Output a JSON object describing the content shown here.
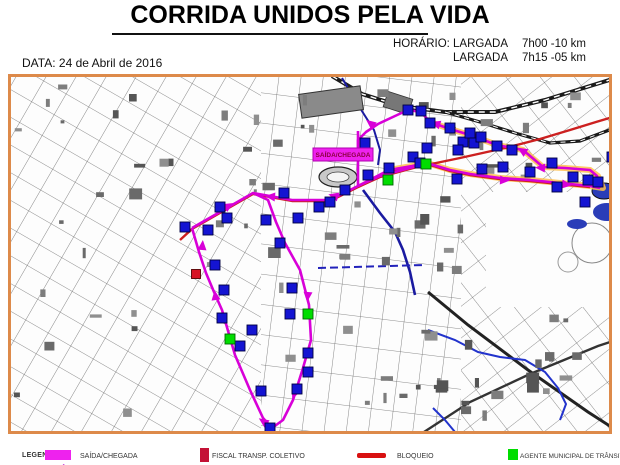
{
  "header": {
    "title": "CORRIDA UNIDOS PELA VIDA",
    "date_label": "DATA: 24 de Abril  de 2016",
    "schedule": {
      "prefix": "HORÁRIO: ",
      "row1": {
        "label": "LARGADA",
        "value": "7h00 -10 km"
      },
      "row2": {
        "label": "LARGADA",
        "value": "7h15 -05 km"
      }
    }
  },
  "colors": {
    "map_border": "#dd8a4a",
    "course": "#d800d8",
    "course_glow": "#ffc04d",
    "start_finish_bg": "#ee22ee",
    "start_finish_text": "#8b0040",
    "bloqueio": "#cc2020",
    "checkpoint_blue": "#1414d2",
    "agent_green": "#00dd00",
    "inspector_red": "#d81324",
    "railway": "#1a1a1a",
    "water": "#2a3db8"
  },
  "map": {
    "start_finish_label": "SAÍDA/CHEGADA",
    "start_finish_box": {
      "x": 313,
      "y": 148,
      "w": 60,
      "h": 13
    },
    "route": {
      "glow": [
        [
          [
            389,
            170
          ],
          [
            412,
            166
          ],
          [
            427,
            163
          ],
          [
            450,
            170
          ],
          [
            470,
            174
          ],
          [
            500,
            178
          ],
          [
            530,
            180
          ],
          [
            560,
            183
          ],
          [
            590,
            186
          ],
          [
            603,
            188
          ],
          [
            598,
            176
          ],
          [
            590,
            170
          ],
          [
            565,
            168
          ],
          [
            543,
            167
          ],
          [
            523,
            150
          ],
          [
            497,
            145
          ],
          [
            470,
            135
          ],
          [
            450,
            129
          ],
          [
            430,
            122
          ]
        ]
      ],
      "bloqueio": [
        [
          [
            616,
            116
          ],
          [
            596,
            122
          ],
          [
            570,
            130
          ],
          [
            540,
            139
          ],
          [
            505,
            148
          ],
          [
            460,
            158
          ],
          [
            417,
            167
          ]
        ],
        [
          [
            417,
            167
          ],
          [
            380,
            177
          ],
          [
            358,
            187
          ],
          [
            330,
            201
          ],
          [
            292,
            201
          ],
          [
            253,
            194
          ],
          [
            192,
            229
          ],
          [
            180,
            240
          ]
        ],
        [
          [
            358,
            187
          ],
          [
            389,
            171
          ],
          [
            412,
            167
          ],
          [
            427,
            164
          ],
          [
            450,
            171
          ],
          [
            470,
            175
          ],
          [
            500,
            179
          ],
          [
            530,
            181
          ],
          [
            560,
            184
          ],
          [
            590,
            187
          ]
        ]
      ],
      "course": [
        [
          [
            358,
            131
          ],
          [
            358,
            186
          ]
        ],
        [
          [
            417,
            166
          ],
          [
            380,
            176
          ],
          [
            358,
            186
          ],
          [
            330,
            200
          ],
          [
            292,
            200
          ],
          [
            253,
            193
          ],
          [
            192,
            228
          ]
        ],
        [
          [
            192,
            228
          ],
          [
            199,
            252
          ],
          [
            206,
            273
          ],
          [
            214,
            292
          ],
          [
            222,
            310
          ],
          [
            235,
            355
          ],
          [
            250,
            390
          ],
          [
            263,
            418
          ],
          [
            272,
            428
          ],
          [
            283,
            420
          ],
          [
            293,
            400
          ],
          [
            303,
            368
          ],
          [
            311,
            340
          ],
          [
            309,
            305
          ],
          [
            300,
            270
          ],
          [
            285,
            243
          ],
          [
            276,
            222
          ],
          [
            268,
            200
          ],
          [
            253,
            193
          ]
        ],
        [
          [
            358,
            186
          ],
          [
            389,
            170
          ],
          [
            412,
            166
          ],
          [
            427,
            163
          ],
          [
            450,
            170
          ],
          [
            470,
            174
          ],
          [
            500,
            178
          ],
          [
            530,
            180
          ],
          [
            560,
            183
          ],
          [
            590,
            186
          ],
          [
            600,
            188
          ]
        ],
        [
          [
            600,
            188
          ],
          [
            597,
            176
          ],
          [
            590,
            170
          ],
          [
            565,
            168
          ],
          [
            543,
            167
          ],
          [
            523,
            150
          ],
          [
            497,
            145
          ],
          [
            470,
            135
          ],
          [
            450,
            129
          ],
          [
            430,
            122
          ],
          [
            421,
            112
          ],
          [
            408,
            110
          ]
        ],
        [
          [
            408,
            110
          ],
          [
            395,
            116
          ],
          [
            378,
            124
          ],
          [
            366,
            132
          ],
          [
            358,
            140
          ],
          [
            358,
            150
          ]
        ]
      ]
    },
    "arrows": [
      {
        "x": 338,
        "y": 197,
        "a": 195
      },
      {
        "x": 275,
        "y": 197,
        "a": 185
      },
      {
        "x": 225,
        "y": 208,
        "a": 330
      },
      {
        "x": 308,
        "y": 292,
        "a": 95
      },
      {
        "x": 296,
        "y": 390,
        "a": 112
      },
      {
        "x": 267,
        "y": 424,
        "a": 215
      },
      {
        "x": 216,
        "y": 300,
        "a": 262
      },
      {
        "x": 202,
        "y": 250,
        "a": 275
      },
      {
        "x": 480,
        "y": 137,
        "a": 197
      },
      {
        "x": 526,
        "y": 153,
        "a": 212
      },
      {
        "x": 545,
        "y": 168,
        "a": 183
      },
      {
        "x": 440,
        "y": 125,
        "a": 197
      },
      {
        "x": 374,
        "y": 126,
        "a": 218
      },
      {
        "x": 500,
        "y": 180,
        "a": 3
      },
      {
        "x": 562,
        "y": 184,
        "a": 8
      }
    ],
    "markers": {
      "blue": [
        [
          408,
          110
        ],
        [
          421,
          111
        ],
        [
          430,
          123
        ],
        [
          450,
          128
        ],
        [
          463,
          142
        ],
        [
          470,
          133
        ],
        [
          474,
          143
        ],
        [
          481,
          137
        ],
        [
          497,
          146
        ],
        [
          512,
          150
        ],
        [
          427,
          148
        ],
        [
          458,
          150
        ],
        [
          457,
          179
        ],
        [
          482,
          169
        ],
        [
          503,
          167
        ],
        [
          530,
          172
        ],
        [
          552,
          163
        ],
        [
          557,
          187
        ],
        [
          573,
          177
        ],
        [
          588,
          180
        ],
        [
          598,
          182
        ],
        [
          585,
          202
        ],
        [
          612,
          157
        ],
        [
          365,
          143
        ],
        [
          413,
          157
        ],
        [
          389,
          168
        ],
        [
          368,
          175
        ],
        [
          420,
          163
        ],
        [
          345,
          190
        ],
        [
          330,
          202
        ],
        [
          319,
          207
        ],
        [
          298,
          218
        ],
        [
          284,
          193
        ],
        [
          185,
          227
        ],
        [
          208,
          230
        ],
        [
          220,
          207
        ],
        [
          227,
          218
        ],
        [
          215,
          265
        ],
        [
          224,
          290
        ],
        [
          266,
          220
        ],
        [
          280,
          243
        ],
        [
          292,
          288
        ],
        [
          222,
          318
        ],
        [
          290,
          314
        ],
        [
          252,
          330
        ],
        [
          240,
          346
        ],
        [
          261,
          391
        ],
        [
          270,
          428
        ],
        [
          297,
          389
        ],
        [
          308,
          353
        ],
        [
          308,
          372
        ]
      ],
      "green": [
        [
          426,
          164
        ],
        [
          388,
          180
        ],
        [
          308,
          314
        ],
        [
          230,
          339
        ]
      ],
      "red": [
        [
          196,
          274
        ]
      ]
    }
  },
  "legend": {
    "title": "LEGENDA:",
    "items": [
      {
        "label": "SAÍDA/CHEGADA",
        "color": "#ee22ee",
        "type": "rect"
      },
      {
        "label": "FISCAL TRANSP. COLETIVO",
        "color": "#c41236",
        "type": "rect"
      },
      {
        "label": "BLOQUEIO",
        "color": "#d81111",
        "type": "line"
      },
      {
        "label": "AGENTE MUNICIPAL DE TRÂNSITO",
        "color": "#00dd00",
        "type": "rect"
      }
    ]
  }
}
